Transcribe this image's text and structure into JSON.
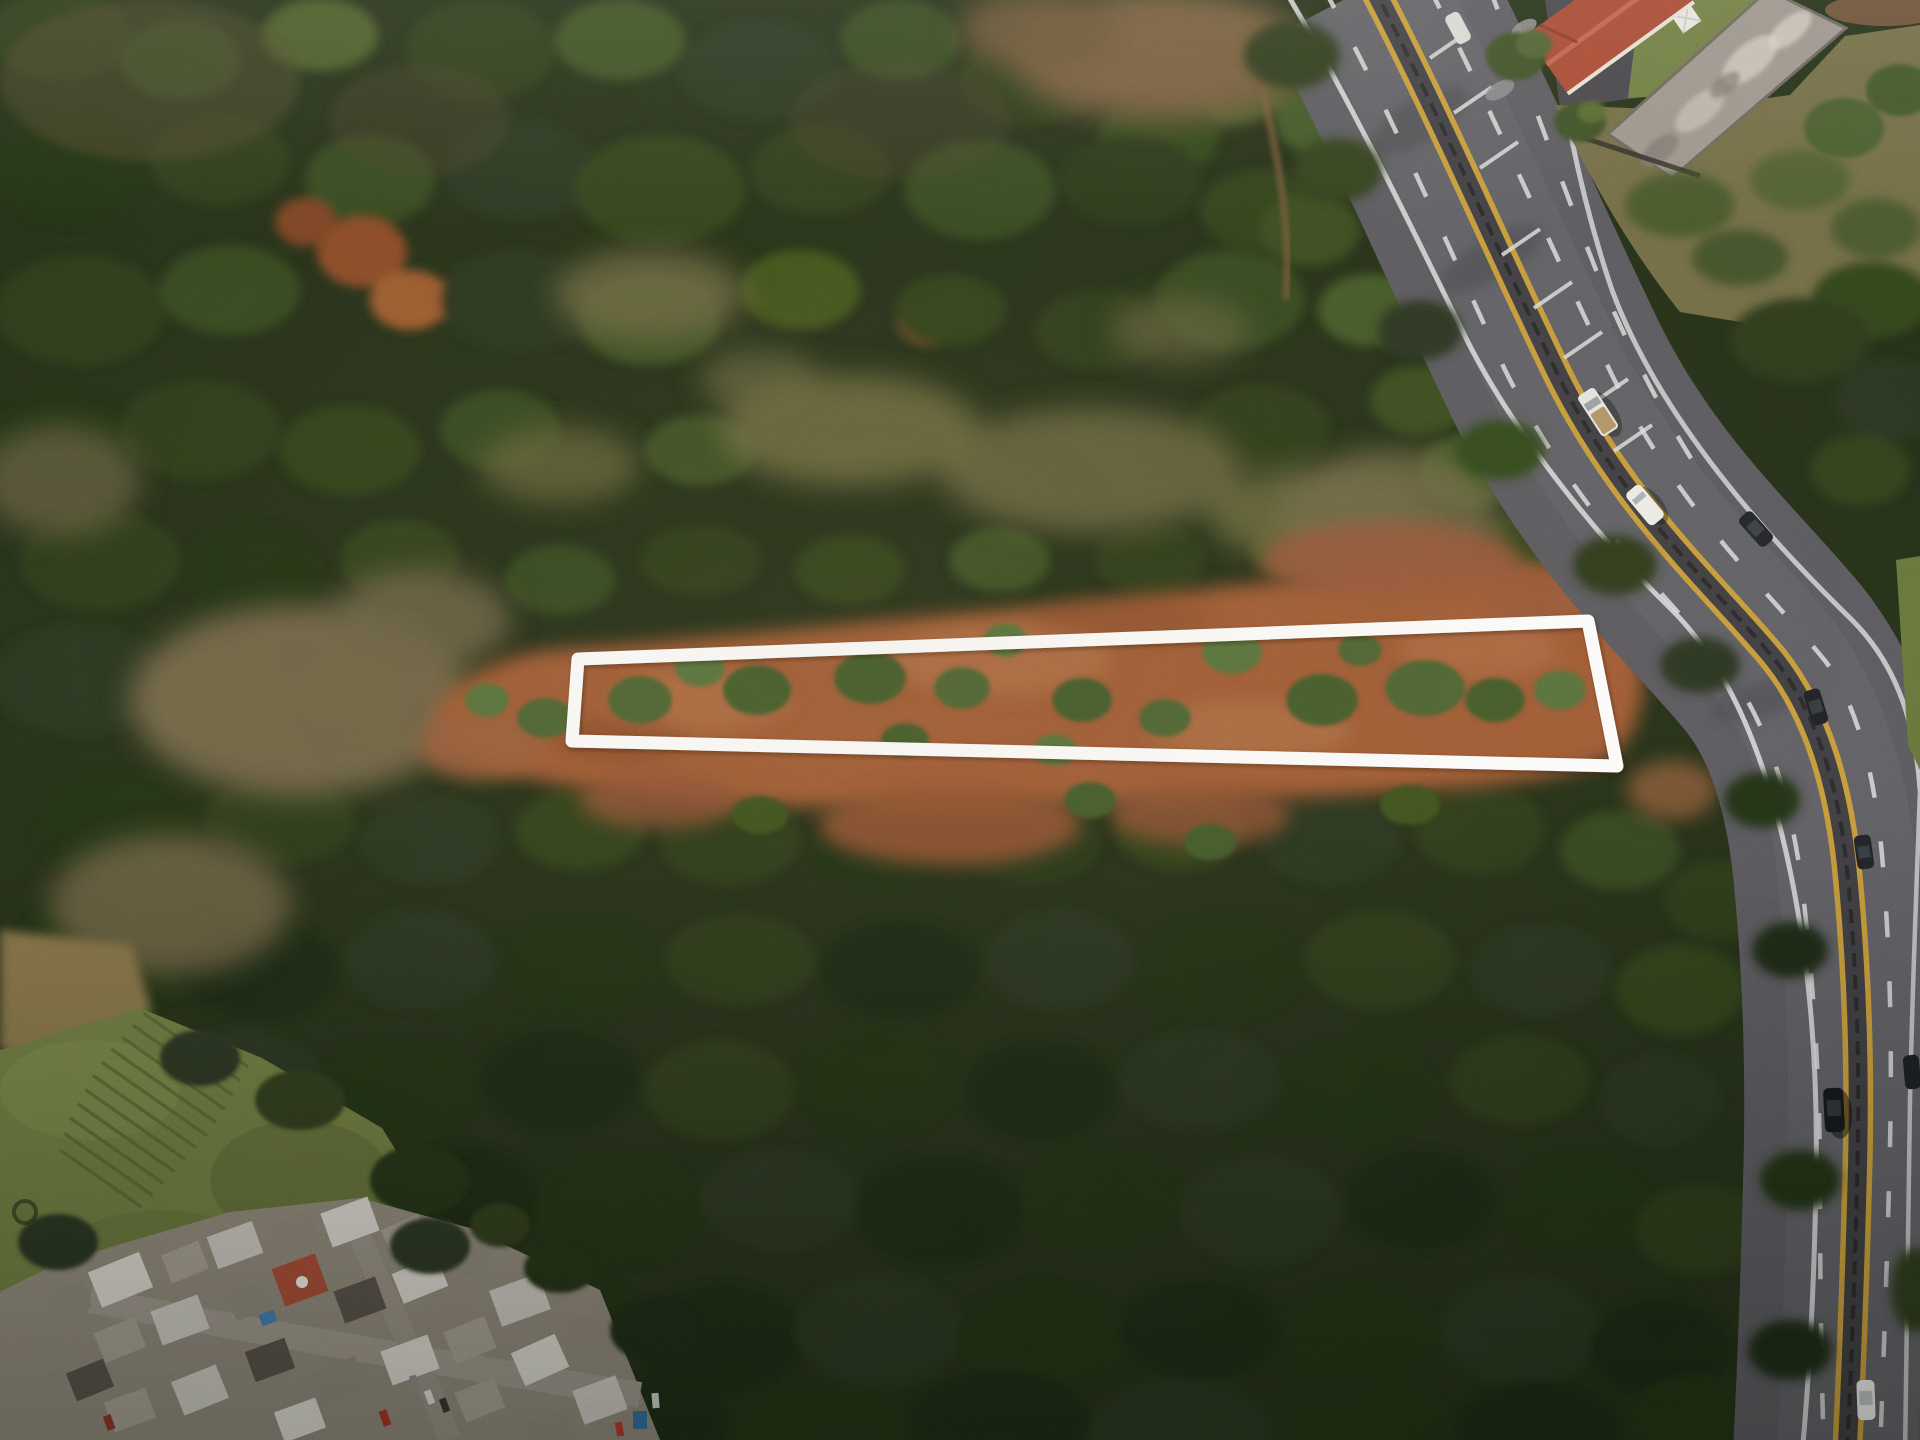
{
  "meta": {
    "kind": "aerial-drone-photograph",
    "view": "top-down (nadir)",
    "text_visible": "none"
  },
  "scene": {
    "colors": {
      "forest_base": "#26301b",
      "forest_deep": "#1f2916",
      "canopy_mid": "#33411f",
      "canopy_light": "#4c612e",
      "meadow_olive": "#67653e",
      "dry_tan": "#77684a",
      "top_dirt": "#755c3d",
      "cleared_dirt": "#9f5a35",
      "dirt_highlight": "#b4724a",
      "road_asphalt": "#5a595f",
      "road_light": "#6a696f",
      "median_dark": "#3f3e42",
      "marking_white": "#dcdddf",
      "marking_yellow": "#c79b3b",
      "outline_white": "#ffffff",
      "lawn_green": "#6e7b41",
      "scrub_tan": "#716b46",
      "grass_right": "#66743c",
      "roof_red": "#a84832",
      "roof_gray": "#9b948c",
      "urban_base": "#8d867a",
      "tent_white": "#e9e7e2"
    },
    "property_outline": {
      "shape": "quadrilateral",
      "stroke_color": "#ffffff",
      "stroke_width_px": 13,
      "corners_px": [
        [
          578,
          659
        ],
        [
          1588,
          621
        ],
        [
          1617,
          766
        ],
        [
          572,
          741
        ]
      ],
      "encloses": "cleared red-dirt strip with scattered shrubs"
    },
    "terrain": {
      "dominant": "dense mixed forest canopy",
      "clearings": "olive dry-grass meadows upslope of the parcel, tan clearing to its left",
      "autumn_trees": "rust-orange crowns near upper left of center",
      "cleared_strip": "long red-dirt parcel running west-east, widening toward the highway"
    },
    "highway": {
      "configuration": "divided highway, two carriageways",
      "median": "paired double yellow lines with dark center barrier",
      "lane_markings": "white dashed lane lines, solid white edge lines, short perpendicular merge bars near the top",
      "path": "enters top center-right, sweeps southeast, then curves due south along the right edge"
    },
    "vehicles": [
      {
        "kind": "pickup-truck",
        "color": "white cab, tan bed",
        "color_hex": "#e8e6e1",
        "x": 1598,
        "y": 412
      },
      {
        "kind": "van",
        "color": "white",
        "color_hex": "#efeeea",
        "x": 1645,
        "y": 505
      },
      {
        "kind": "car",
        "color": "dark",
        "color_hex": "#23262a",
        "x": 1756,
        "y": 529
      },
      {
        "kind": "car",
        "color": "dark",
        "color_hex": "#1e2226",
        "x": 1816,
        "y": 707
      },
      {
        "kind": "car",
        "color": "dark",
        "color_hex": "#202428",
        "x": 1864,
        "y": 852
      },
      {
        "kind": "suv",
        "color": "black",
        "color_hex": "#15181c",
        "x": 1834,
        "y": 1110
      },
      {
        "kind": "car",
        "color": "dark",
        "color_hex": "#1c1f24",
        "x": 1912,
        "y": 1072
      },
      {
        "kind": "sedan",
        "color": "white",
        "color_hex": "#e9e9ea",
        "x": 1866,
        "y": 1400
      },
      {
        "kind": "car",
        "color": "white",
        "color_hex": "#dddcd8",
        "x": 1458,
        "y": 28
      }
    ],
    "top_right_complex": {
      "red_roof_building": "terracotta hip roof, cropped by top edge",
      "long_gray_building": "weathered pale roof running parallel to the road",
      "lawn": "green yard with small white canopy",
      "parking": "dark asphalt apron beside the road"
    },
    "bottom_left_area": {
      "field": "green lawn with planted crop rows and a small round planter",
      "neighborhood": "dense cluster of small mixed rooftops (white, gray, red, blue) with narrow streets and parked cars"
    }
  }
}
